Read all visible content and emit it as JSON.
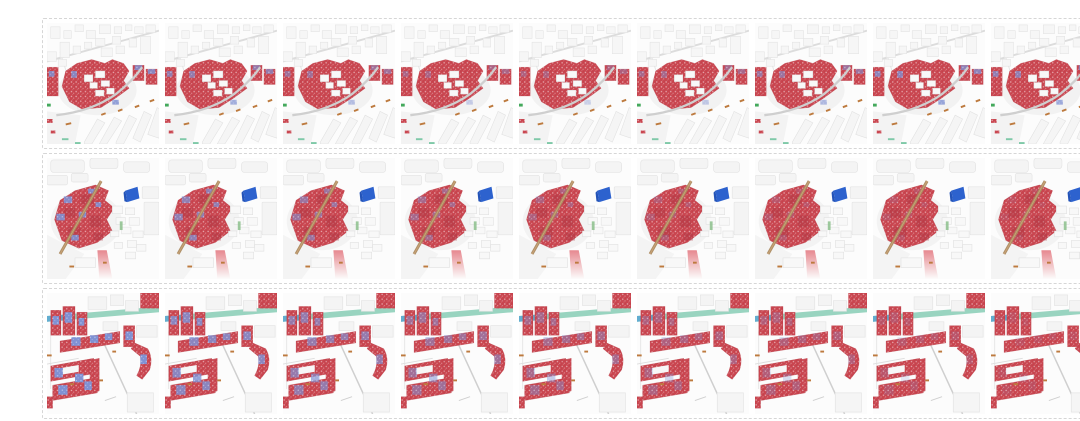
{
  "figure": {
    "description": "Three nine-frame sequences of aerial 3D urban scene renderings; buildings of interest are colored speckled red with scattered periwinkle-blue patches, surrounded by plain white city blocks",
    "palette": {
      "building_red": "#c9454f",
      "building_red_dark": "#a83340",
      "highlight_blue": "#8091d3",
      "flag_blue": "#2d62ce",
      "road_tan": "#ab8a60",
      "canal_teal": "#99d4c0",
      "canal_blue": "#62add0",
      "accent_orange": "#bd7a3e",
      "accent_green": "#44a95c",
      "white_building": "#f5f5f5",
      "road_gray": "#cfcfcf",
      "row_border": "#d6d6d6",
      "page_background": "#ffffff"
    },
    "rows": [
      {
        "id": "sequence-row-1",
        "scene": "scene-arc-block",
        "frame_count": 9,
        "description": "Nine rendered frames of an aerial city scene: a red-highlighted building cluster wrapped by a curved gray road, white tower blocks above, diagonal rows of white slab buildings below-right, small orange and green ground marks",
        "frames": [
          {
            "index": 1,
            "blue_opacity": 0.85
          },
          {
            "index": 2,
            "blue_opacity": 0.7
          },
          {
            "index": 3,
            "blue_opacity": 0.55
          },
          {
            "index": 4,
            "blue_opacity": 0.4
          },
          {
            "index": 5,
            "blue_opacity": 0.35
          },
          {
            "index": 6,
            "blue_opacity": 0.45
          },
          {
            "index": 7,
            "blue_opacity": 0.6
          },
          {
            "index": 8,
            "blue_opacity": 0.8
          },
          {
            "index": 9,
            "blue_opacity": 0.75
          }
        ]
      },
      {
        "id": "sequence-row-2",
        "scene": "scene-flag-block",
        "frame_count": 9,
        "description": "Nine rendered frames of an aerial city scene: a large red-highlighted block crossed by a tan diagonal road, a bright blue flag-shaped marker at upper right, small white buildings on the right and a fading red strip at bottom",
        "frames": [
          {
            "index": 1,
            "blue_opacity": 0.9
          },
          {
            "index": 2,
            "blue_opacity": 0.75
          },
          {
            "index": 3,
            "blue_opacity": 0.6
          },
          {
            "index": 4,
            "blue_opacity": 0.45
          },
          {
            "index": 5,
            "blue_opacity": 0.35
          },
          {
            "index": 6,
            "blue_opacity": 0.25
          },
          {
            "index": 7,
            "blue_opacity": 0.2
          },
          {
            "index": 8,
            "blue_opacity": 0.15
          },
          {
            "index": 9,
            "blue_opacity": 0.1
          }
        ]
      },
      {
        "id": "sequence-row-3",
        "scene": "scene-slab-blocks",
        "frame_count": 9,
        "description": "Nine rendered frames of a 3D scene of red slab apartment blocks with blue facade patches that fade across frames, a teal canal strip at top, thin gray roads and white low-rise surroundings",
        "frames": [
          {
            "index": 1,
            "blue_opacity": 1.0
          },
          {
            "index": 2,
            "blue_opacity": 0.85
          },
          {
            "index": 3,
            "blue_opacity": 0.7
          },
          {
            "index": 4,
            "blue_opacity": 0.55
          },
          {
            "index": 5,
            "blue_opacity": 0.45
          },
          {
            "index": 6,
            "blue_opacity": 0.35
          },
          {
            "index": 7,
            "blue_opacity": 0.3
          },
          {
            "index": 8,
            "blue_opacity": 0.2
          },
          {
            "index": 9,
            "blue_opacity": 0.12
          }
        ]
      }
    ]
  }
}
